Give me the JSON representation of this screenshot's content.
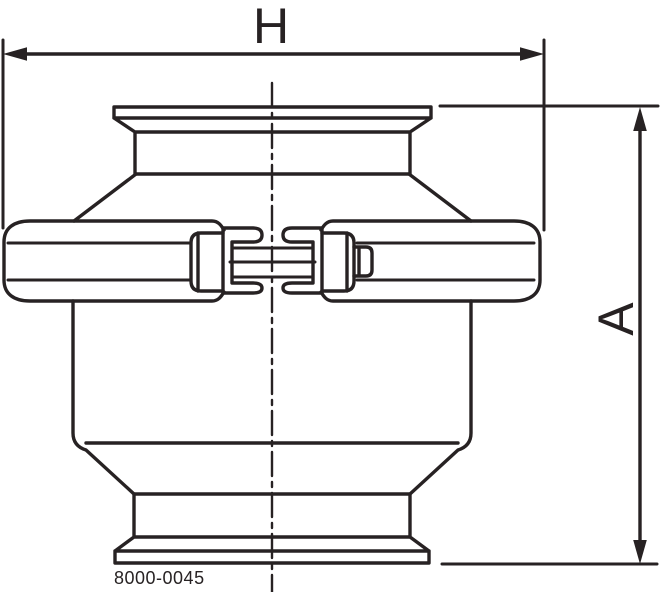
{
  "drawing": {
    "dimension_labels": {
      "width": "H",
      "height": "A"
    },
    "part_number": "8000-0045",
    "line_color": "#272223",
    "background_color": "#ffffff"
  }
}
